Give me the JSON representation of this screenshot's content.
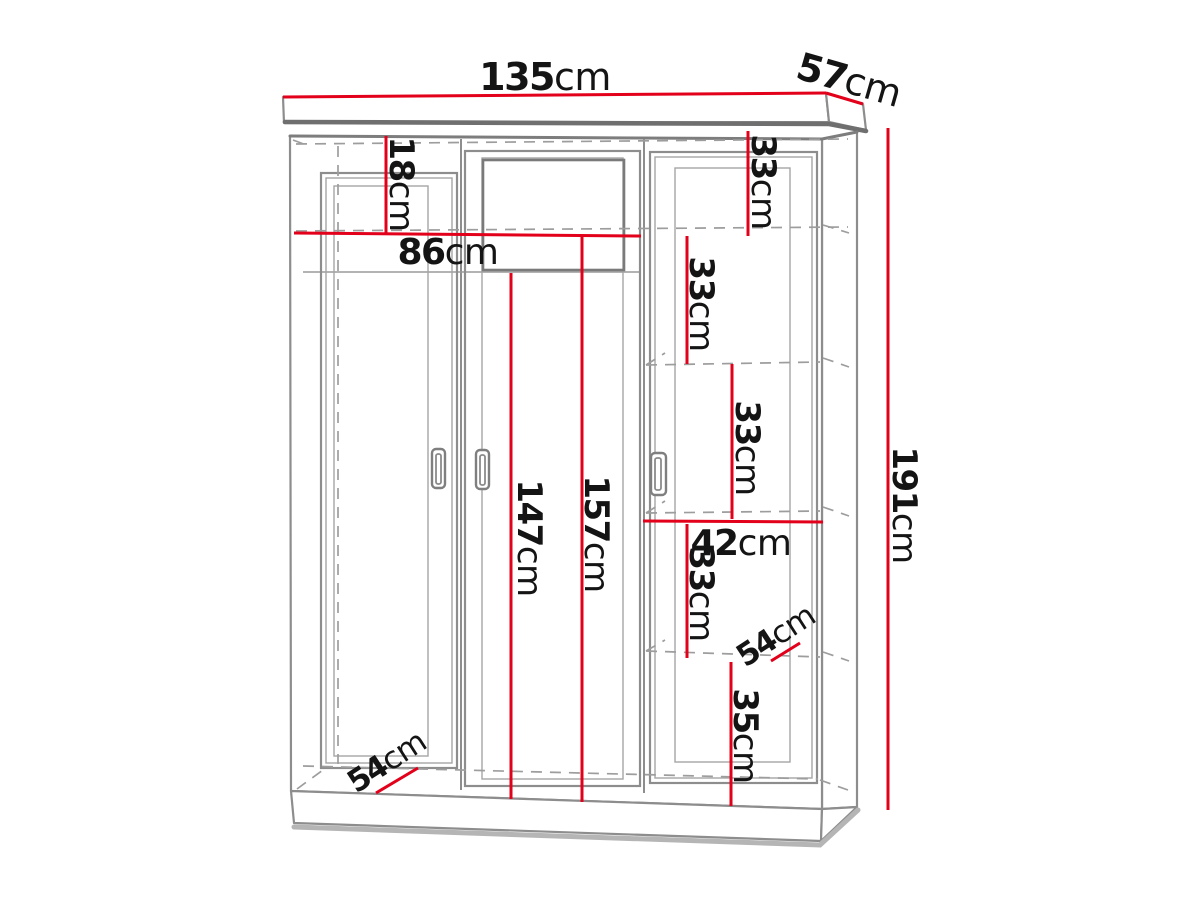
{
  "diagram": {
    "type": "furniture-dimension-diagram",
    "subject": "three-door wardrobe technical line drawing with red dimension lines",
    "unit": "cm",
    "overall": {
      "width": "135",
      "depth": "57",
      "height": "191"
    },
    "colors": {
      "dimension_red": "#e2001a",
      "outline_gray": "#8d8d8d",
      "hidden_line_gray": "#9d9d9d",
      "text_black": "#141414",
      "background": "#ffffff"
    },
    "dimensions": [
      {
        "id": "overall-width",
        "value": "135",
        "unit": "cm",
        "label": {
          "x": 545,
          "y": 77,
          "size": 38,
          "rotate": 0
        },
        "line": {
          "x1": 283,
          "y1": 97,
          "x2": 826,
          "y2": 93
        }
      },
      {
        "id": "overall-depth",
        "value": "57",
        "unit": "cm",
        "label": {
          "x": 849,
          "y": 80,
          "size": 38,
          "rotate": 16
        },
        "line": {
          "x1": 826,
          "y1": 93,
          "x2": 863,
          "y2": 104
        }
      },
      {
        "id": "top-section-height",
        "value": "18",
        "unit": "cm",
        "label": {
          "x": 401,
          "y": 184,
          "size": 34,
          "rotate": 90
        },
        "line": {
          "x1": 386,
          "y1": 136,
          "x2": 386,
          "y2": 234
        }
      },
      {
        "id": "inner-width",
        "value": "86",
        "unit": "cm",
        "label": {
          "x": 448,
          "y": 252,
          "size": 36,
          "rotate": 0
        },
        "line": {
          "x1": 294,
          "y1": 233,
          "x2": 641,
          "y2": 236
        }
      },
      {
        "id": "left-door-height",
        "value": "147",
        "unit": "cm",
        "label": {
          "x": 529,
          "y": 538,
          "size": 34,
          "rotate": 90
        },
        "line": {
          "x1": 511,
          "y1": 273,
          "x2": 511,
          "y2": 799
        }
      },
      {
        "id": "middle-door-height",
        "value": "157",
        "unit": "cm",
        "label": {
          "x": 596,
          "y": 534,
          "size": 34,
          "rotate": 90
        },
        "line": {
          "x1": 582,
          "y1": 236,
          "x2": 582,
          "y2": 802
        }
      },
      {
        "id": "shelf-space-1",
        "value": "33",
        "unit": "cm",
        "label": {
          "x": 763,
          "y": 182,
          "size": 34,
          "rotate": 90
        },
        "line": {
          "x1": 748,
          "y1": 131,
          "x2": 748,
          "y2": 236
        }
      },
      {
        "id": "shelf-space-2",
        "value": "33",
        "unit": "cm",
        "label": {
          "x": 701,
          "y": 304,
          "size": 34,
          "rotate": 90
        },
        "line": {
          "x1": 687,
          "y1": 236,
          "x2": 687,
          "y2": 364
        }
      },
      {
        "id": "shelf-space-3",
        "value": "33",
        "unit": "cm",
        "label": {
          "x": 747,
          "y": 448,
          "size": 34,
          "rotate": 90
        },
        "line": {
          "x1": 732,
          "y1": 364,
          "x2": 732,
          "y2": 519
        }
      },
      {
        "id": "shelf-width",
        "value": "42",
        "unit": "cm",
        "label": {
          "x": 741,
          "y": 543,
          "size": 36,
          "rotate": 0
        },
        "line": {
          "x1": 643,
          "y1": 521,
          "x2": 823,
          "y2": 522
        }
      },
      {
        "id": "shelf-space-4",
        "value": "33",
        "unit": "cm",
        "label": {
          "x": 701,
          "y": 594,
          "size": 34,
          "rotate": 90
        },
        "line": {
          "x1": 687,
          "y1": 524,
          "x2": 687,
          "y2": 658
        }
      },
      {
        "id": "shelf-depth",
        "value": "54",
        "unit": "cm",
        "label": {
          "x": 776,
          "y": 636,
          "size": 31,
          "rotate": -33
        },
        "line": {
          "x1": 771,
          "y1": 661,
          "x2": 800,
          "y2": 643
        }
      },
      {
        "id": "bottom-section-height",
        "value": "35",
        "unit": "cm",
        "label": {
          "x": 745,
          "y": 736,
          "size": 34,
          "rotate": 90
        },
        "line": {
          "x1": 731,
          "y1": 662,
          "x2": 731,
          "y2": 806
        }
      },
      {
        "id": "floor-depth",
        "value": "54",
        "unit": "cm",
        "label": {
          "x": 387,
          "y": 762,
          "size": 31,
          "rotate": -33
        },
        "line": {
          "x1": 376,
          "y1": 793,
          "x2": 418,
          "y2": 768
        }
      },
      {
        "id": "overall-height",
        "value": "191",
        "unit": "cm",
        "label": {
          "x": 904,
          "y": 505,
          "size": 34,
          "rotate": 90
        },
        "line": {
          "x1": 888,
          "y1": 128,
          "x2": 888,
          "y2": 810
        }
      }
    ]
  }
}
